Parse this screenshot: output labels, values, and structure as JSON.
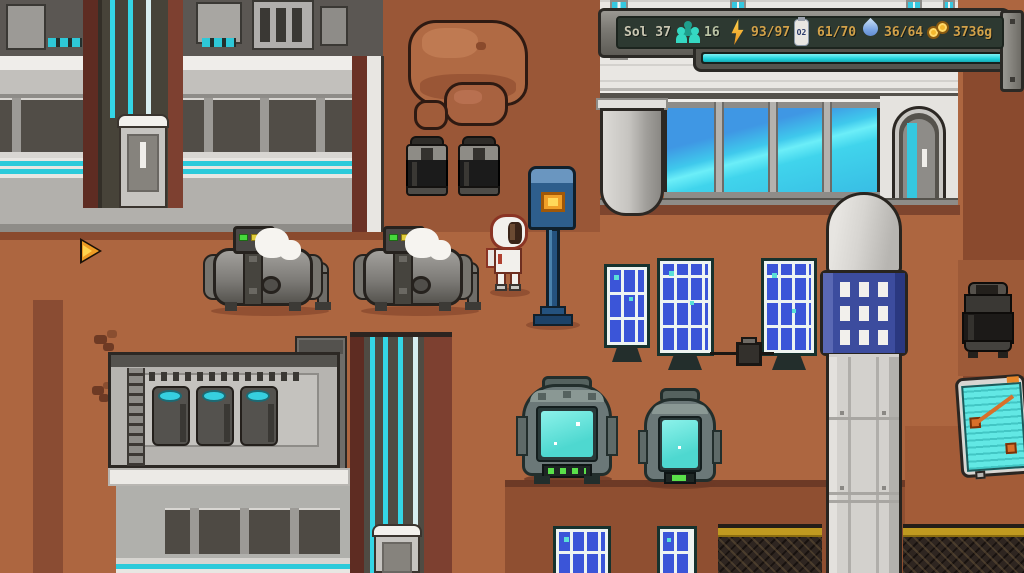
{
  "hud": {
    "sol_label": "Sol 37",
    "stats": [
      {
        "name": "population",
        "icon": "people-icon",
        "value": "16"
      },
      {
        "name": "power",
        "icon": "lightning-icon",
        "value": "93/97"
      },
      {
        "name": "oxygen",
        "icon": "oxygen-tank-icon",
        "icon_label": "O2",
        "value": "61/70"
      },
      {
        "name": "water",
        "icon": "water-drop-icon",
        "value": "36/64"
      },
      {
        "name": "credits",
        "icon": "coins-icon",
        "value": "3736g"
      }
    ],
    "colors": {
      "sol_text": "#c9c6b2",
      "population_value": "#b9c2a4",
      "stat_value": "#d2a149",
      "icon_teal": "#35d8c2",
      "screen_bg": "#2d3931",
      "progress_fill": "#2de2ea"
    }
  },
  "palette": {
    "terrain_base": "#ad6640",
    "terrain_upper": "#9a5737",
    "terrain_dark_stripe": "#8a4c33",
    "plaza": "#8f4f31",
    "right_column": "#8a4a2e",
    "accent_cyan": "#2ccada",
    "maroon_shaft": "#6b3226",
    "solar_blue": "#3b55d8",
    "window_glass": "#3fc9ec",
    "field_yellow": "#c09a20",
    "rock_brown": "#b06a44",
    "post_blue": "#2e5e8c",
    "post_screen_orange": "#f0a028",
    "machine_screen": "#6ae8e0",
    "steam_white": "#f6f4f0"
  }
}
